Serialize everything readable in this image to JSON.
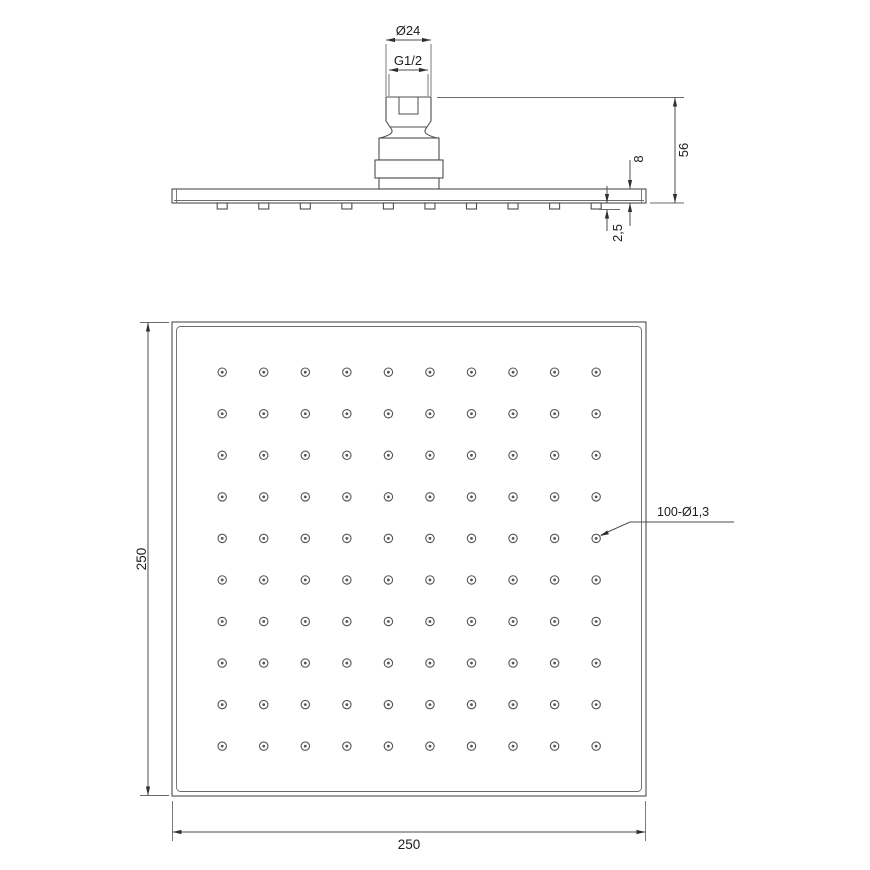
{
  "title": "Square shower head technical drawing",
  "colors": {
    "line": "#4d4d4d",
    "text": "#1c1c1c",
    "background": "#ffffff"
  },
  "side_view": {
    "name": "side-elevation",
    "dims": {
      "thread_outer_diameter": "Ø24",
      "thread_size": "G1/2",
      "total_height": "56",
      "plate_thickness": "8",
      "nozzle_protrusion": "2,5"
    },
    "nozzle_count": 10
  },
  "face_view": {
    "name": "spray-face",
    "dims": {
      "height": "250",
      "width": "250"
    },
    "holes_label": "100-Ø1,3",
    "hole_grid": {
      "rows": 10,
      "cols": 10
    }
  }
}
